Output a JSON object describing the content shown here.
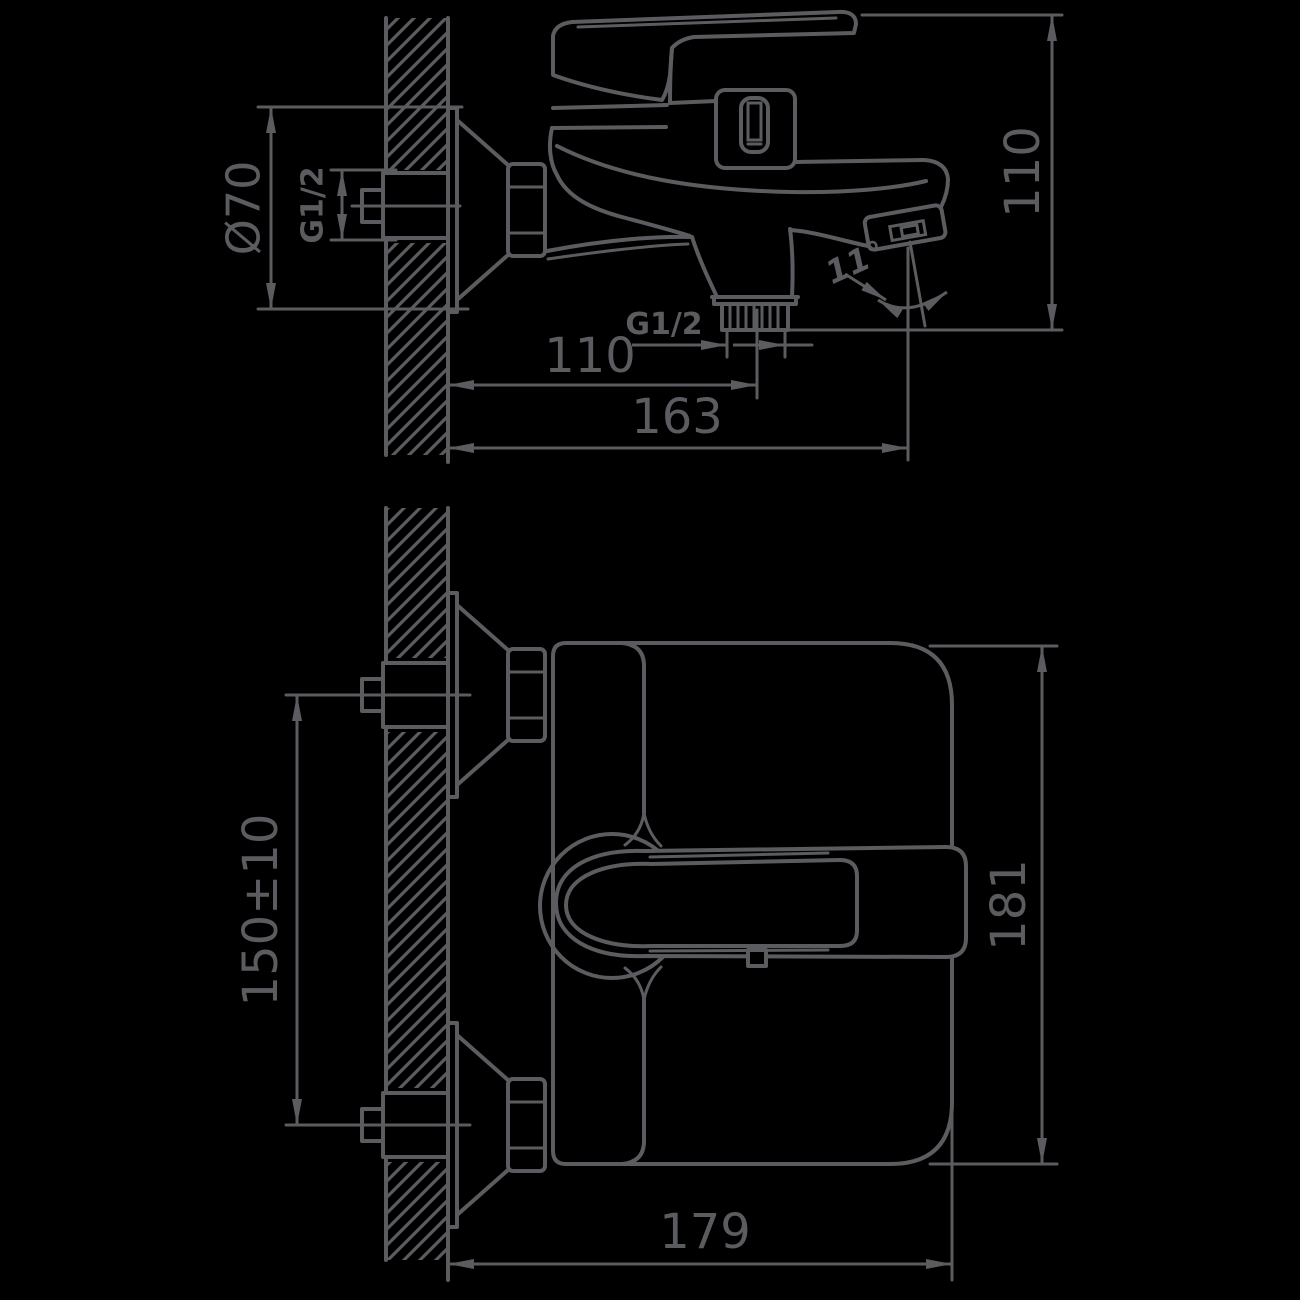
{
  "colors": {
    "background": "#000000",
    "line": "#5b5c5f"
  },
  "side_view": {
    "labels": {
      "escutcheon_diameter": "Ø70",
      "wall_thread": "G1/2",
      "overall_height": "110",
      "outlet_thread": "G1/2",
      "outlet_offset": "110",
      "spout_reach": "163",
      "spout_angle": "11°"
    }
  },
  "front_view": {
    "labels": {
      "inlet_spacing": "150±10",
      "body_height": "181",
      "body_depth": "179"
    }
  }
}
